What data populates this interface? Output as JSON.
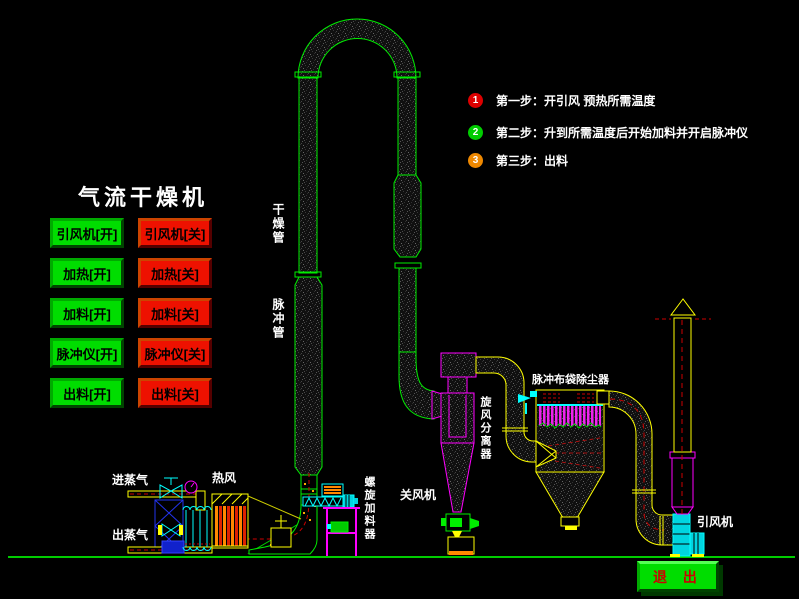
{
  "title": "气流干燥机",
  "controls": {
    "on_buttons": [
      "引风机[开]",
      "加热[开]",
      "加料[开]",
      "脉冲仪[开]",
      "出料[开]"
    ],
    "off_buttons": [
      "引风机[关]",
      "加热[关]",
      "加料[关]",
      "脉冲仪[关]",
      "出料[关]"
    ]
  },
  "steps": [
    {
      "num": "1",
      "color": "#dd0000",
      "text": "第一步：开引风 预热所需温度"
    },
    {
      "num": "2",
      "color": "#00cc00",
      "text": "第二步：升到所需温度后开始加料并开启脉冲仪"
    },
    {
      "num": "3",
      "color": "#ee8800",
      "text": "第三步：出料"
    }
  ],
  "diagram_labels": {
    "drying_pipe": "干燥管",
    "pulse_pipe": "脉冲管",
    "cyclone": "旋风分离器",
    "bag_filter": "脉冲布袋除尘器",
    "rotary_valve": "关风机",
    "screw_feeder": "螺旋加料器",
    "steam_in": "进蒸气",
    "steam_out": "出蒸气",
    "hot_air": "热风",
    "draft_fan": "引风机"
  },
  "exit_label": "退 出",
  "colors": {
    "button_on": "#00dd00",
    "button_off": "#ee1100",
    "pipe_green": "#00ff00",
    "pipe_yellow": "#ffff00",
    "pipe_magenta": "#ff00ff",
    "device_cyan": "#00ffff",
    "dash_red": "#cc0000",
    "ground_green": "#00cc00"
  }
}
